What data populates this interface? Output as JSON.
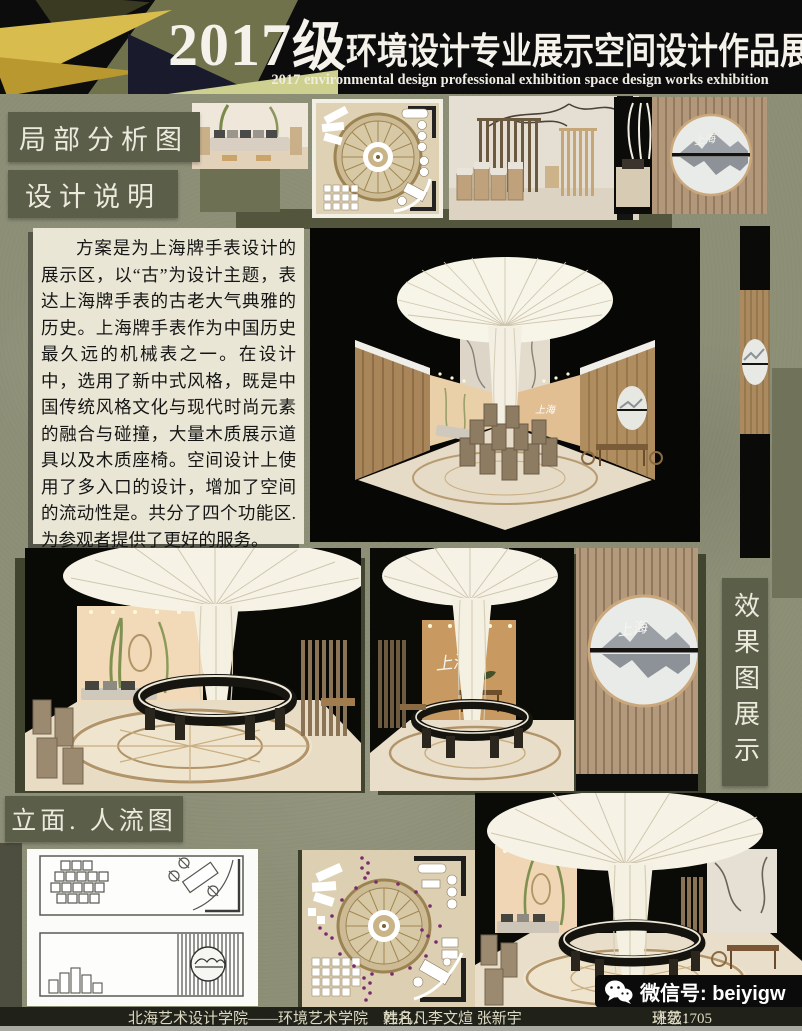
{
  "poster": {
    "header": {
      "year": "2017",
      "grade_suffix": "级",
      "title_cn": "环境设计专业展示空间设计作品展",
      "title_en": "2017 environmental design professional exhibition space design works exhibition"
    },
    "section_labels": {
      "partial_analysis": "局部分析图",
      "design_notes": "设计说明",
      "elevation_flow": "立面. 人流图",
      "render_display": "效果图展示"
    },
    "design_notes_text": "方案是为上海牌手表设计的展示区，以“古”为设计主题，表达上海牌手表的古老大气典雅的历史。上海牌手表作为中国历史最久远的机械表之一。在设计中，选用了新中式风格，既是中国传统风格文化与现代时尚元素的融合与碰撞，大量木质展示道具以及木质座椅。空间设计上使用了多入口的设计，增加了空间的流动性是。共分了四个功能区.为参观者提供了更好的服务。",
    "footer": {
      "school": "北海艺术设计学院——环境艺术学院",
      "name_label": "姓名：",
      "names": "韩凡凡李文煊 张新宇",
      "class_label": "班级：",
      "class_value": "环艺1705"
    },
    "wechat_badge": {
      "icon": "wechat-icon",
      "text": "微信号: beiyigw"
    },
    "artwork_text": {
      "shanghai_logo": "上海"
    },
    "colors": {
      "background_olive": "#8d8f77",
      "header_black": "#0c0c0c",
      "label_box": "#5b5e49",
      "accent_gold": "#d9bc4e",
      "paragraph_bg": "#e9e6d5",
      "footer_bar": "#20221a",
      "flow_dot_purple": "#7a2b6e"
    }
  }
}
